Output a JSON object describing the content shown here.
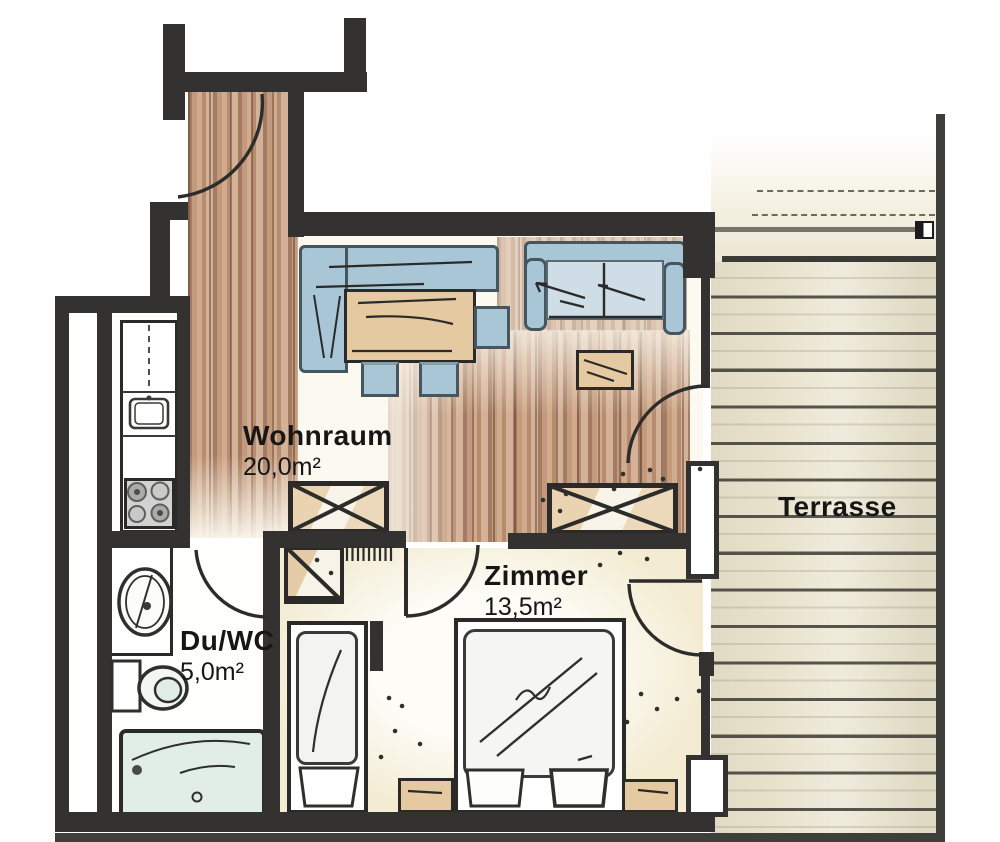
{
  "rooms": [
    {
      "key": "wohnraum",
      "label": "Wohnraum",
      "area": "20,0m²"
    },
    {
      "key": "zimmer",
      "label": "Zimmer",
      "area": "13,5m²"
    },
    {
      "key": "du_wc",
      "label": "Du/WC",
      "area": "5,0m²"
    },
    {
      "key": "terrasse",
      "label": "Terrasse"
    }
  ],
  "colors": {
    "wall": "#333231",
    "wallSoft": "#3e3e3a",
    "paper": "#ffffff",
    "woodBase": "#c49a7c",
    "sofaBlue": "#a9c6d7",
    "sofaSeat": "#d9e4ea",
    "furnTan": "#e5c9a0",
    "terraceBase": "#e9e3cd",
    "zimmerFloor": "#f3ecd2",
    "mint": "#e1eee5",
    "ink": "#2b2a28"
  }
}
